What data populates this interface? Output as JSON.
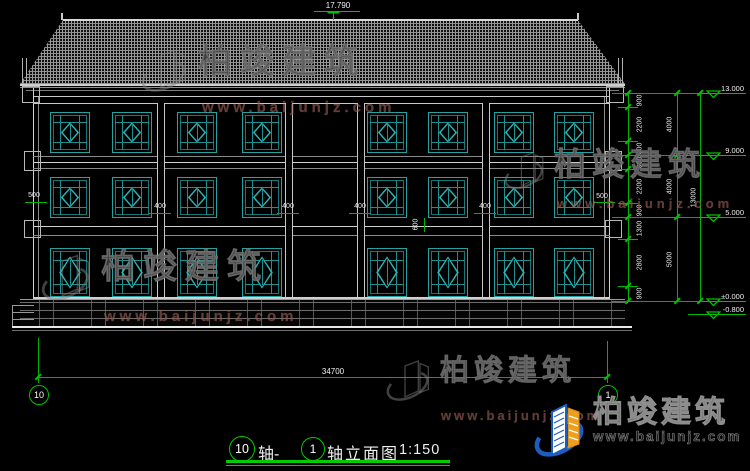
{
  "watermark": {
    "brand": "柏竣建筑",
    "url": "www.baijunjz.com"
  },
  "annotations": {
    "ridge_level": "17.790",
    "overall_width": "34700",
    "left_offset": "500",
    "right_offset": "500",
    "pilaster_width": "400",
    "sill_height": "600"
  },
  "axes": {
    "left": "10",
    "right": "1"
  },
  "title": {
    "axis_start": "10",
    "connector": "轴-",
    "axis_end": "1",
    "name": "轴立面图",
    "scale": "1:150"
  },
  "right_dimensions": {
    "segments": [
      "900",
      "2200",
      "900",
      "900",
      "2200",
      "900",
      "1300",
      "2800",
      "900"
    ],
    "subtotals": [
      "4000",
      "4000",
      "5000"
    ],
    "overall": "13000",
    "levels": [
      "13.000",
      "9.000",
      "5.000",
      "±0.000",
      "-0.800"
    ]
  }
}
